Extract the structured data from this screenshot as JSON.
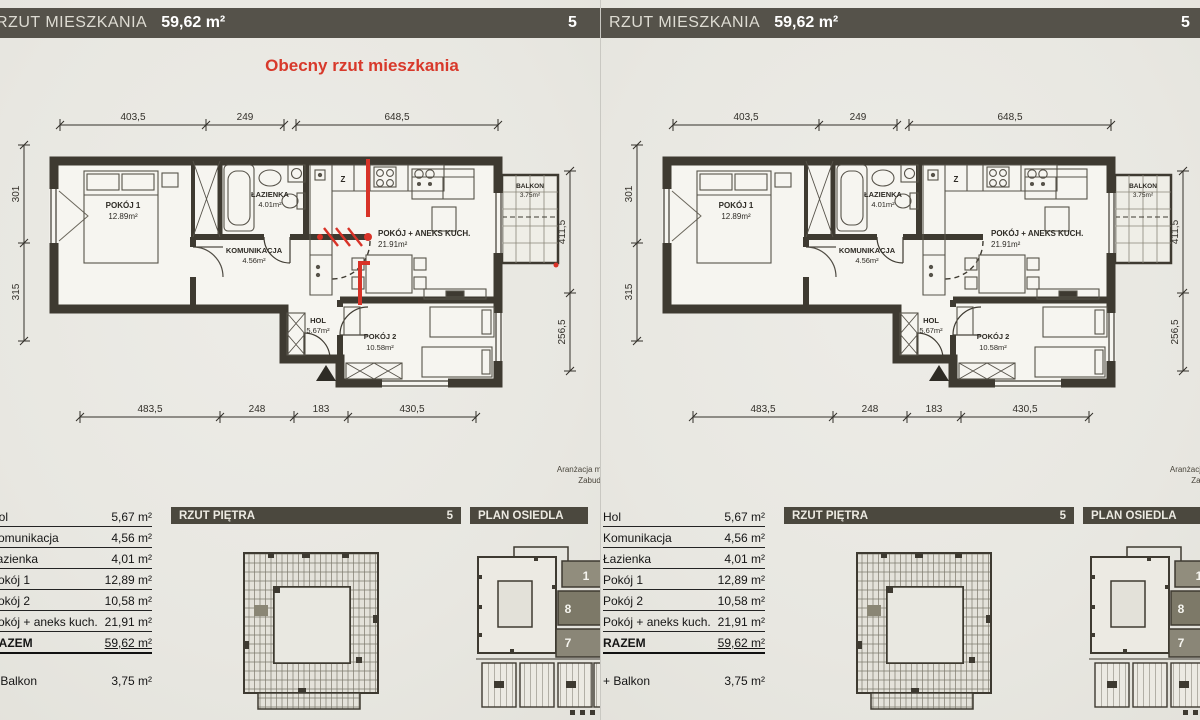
{
  "doc": {
    "header": {
      "title": "RZUT MIESZKANIA",
      "area": "59,62 m²",
      "page": "5"
    },
    "annotation": {
      "title": "Obecny rzut mieszkania"
    },
    "plan": {
      "rooms": [
        {
          "name": "POKÓJ 1",
          "area": "12.89m²"
        },
        {
          "name": "ŁAZIENKA",
          "area": "4.01m²"
        },
        {
          "name": "KOMUNIKACJA",
          "area": "4.56m²"
        },
        {
          "name": "POKÓJ + ANEKS KUCH.",
          "area": "21.91m²"
        },
        {
          "name": "HOL",
          "area": "5.67m²"
        },
        {
          "name": "POKÓJ 2",
          "area": "10.58m²"
        },
        {
          "name": "BALKON",
          "area": "3.75m²"
        }
      ],
      "kitchen_sign": "Z",
      "dims_top": [
        "403,5",
        "249",
        "648,5"
      ],
      "dims_bottom": [
        "483,5",
        "248",
        "183",
        "430,5"
      ],
      "dims_left": [
        "301",
        "315"
      ],
      "dims_right": [
        "411,5",
        "256,5"
      ]
    },
    "fine_print": [
      "Aranżacja mieszka",
      "Zabudowa G",
      "odpły"
    ],
    "table": {
      "rows": [
        {
          "label": "Hol",
          "value": "5,67 m²"
        },
        {
          "label": "Komunikacja",
          "value": "4,56 m²"
        },
        {
          "label": "Łazienka",
          "value": "4,01 m²"
        },
        {
          "label": "Pokój 1",
          "value": "12,89 m²"
        },
        {
          "label": "Pokój 2",
          "value": "10,58 m²"
        },
        {
          "label": "Pokój + aneks kuch.",
          "value": "21,91 m²"
        }
      ],
      "total": {
        "label": "RAZEM",
        "value": "59,62 m²"
      },
      "extra": {
        "label": "+ Balkon",
        "value": "3,75 m²"
      }
    },
    "floor_plan_header": {
      "title": "RZUT PIĘTRA",
      "page": "5"
    },
    "site_plan_header": {
      "title": "PLAN OSIEDLA"
    },
    "site_numbers": [
      "1",
      "8",
      "7"
    ]
  }
}
